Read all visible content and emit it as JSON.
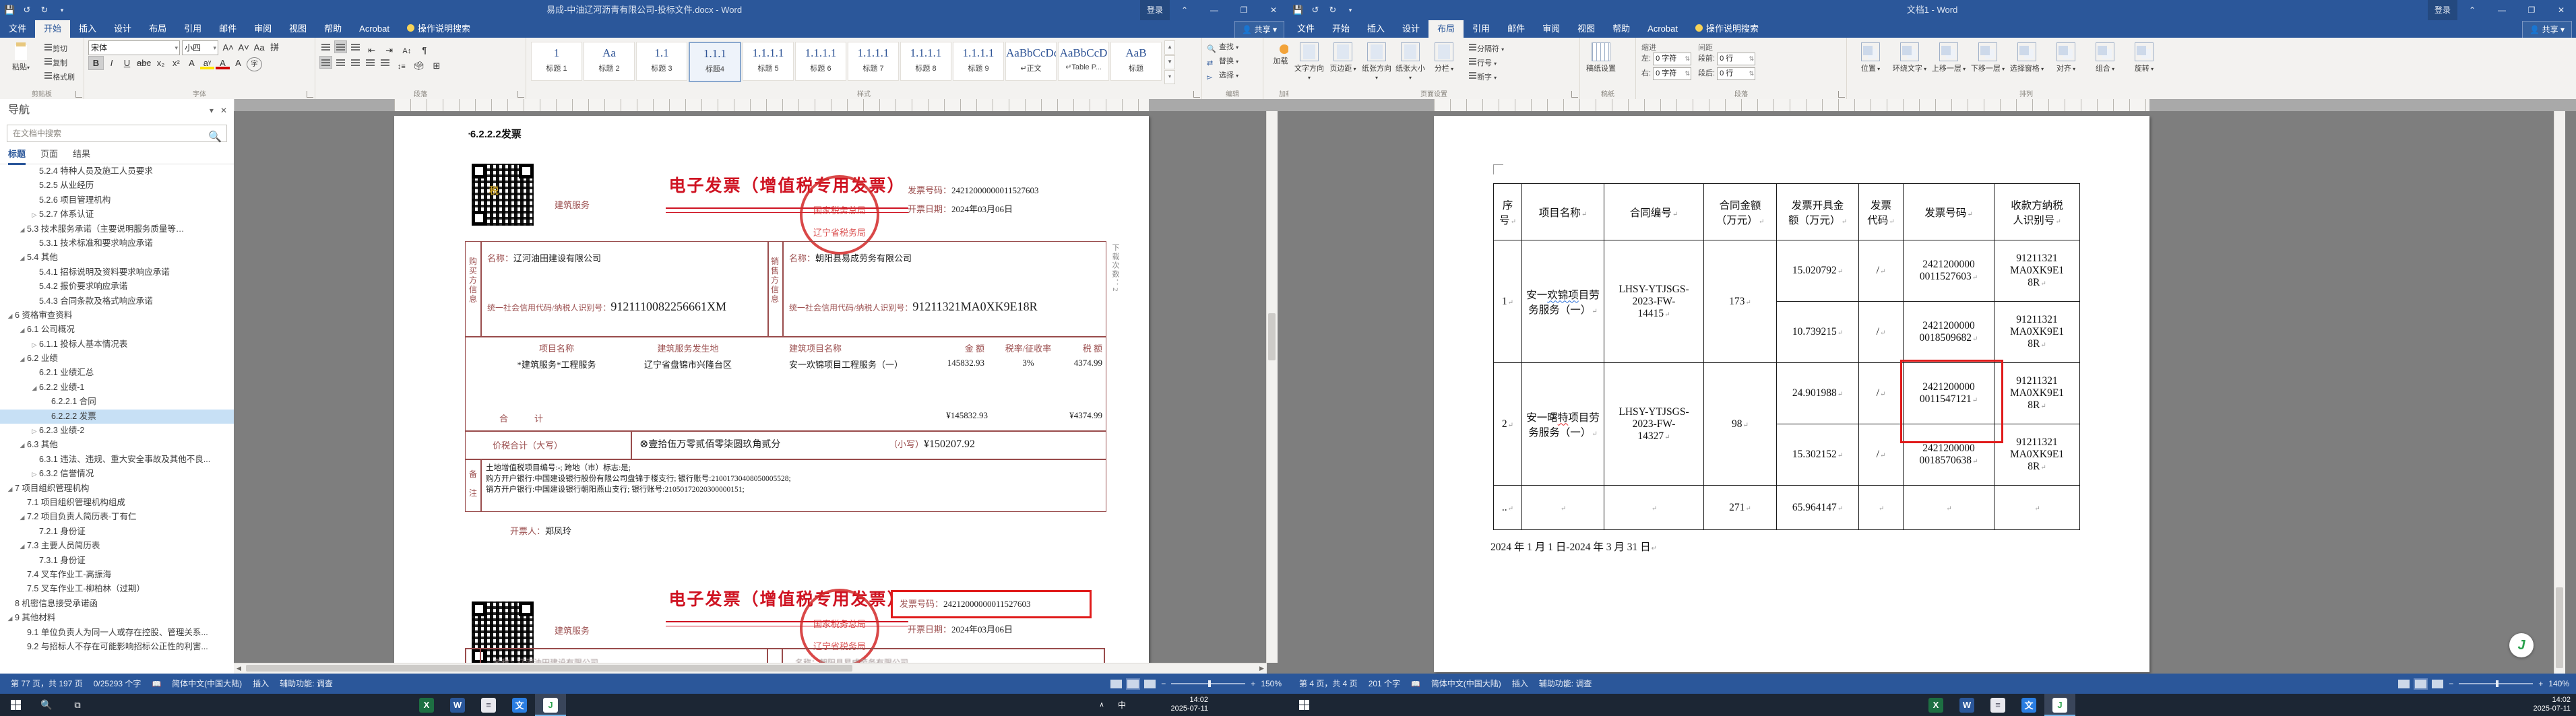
{
  "chrome": {
    "tabs": [
      "文件",
      "开始",
      "插入",
      "设计",
      "布局",
      "引用",
      "邮件",
      "审阅",
      "视图",
      "帮助",
      "Acrobat"
    ],
    "search_tab": "操作说明搜索",
    "share": "共享",
    "signin": "登录",
    "window_buttons": {
      "ribbon_options": "⌃",
      "minimize": "—",
      "restore": "❐",
      "close": "✕"
    },
    "qat_icons": [
      "save-icon",
      "undo-icon",
      "repeat-icon",
      "customize-arrow"
    ]
  },
  "left_window": {
    "title": "易成-中油辽河沥青有限公司-投标文件.docx - Word",
    "active_tab": "开始",
    "ribbon": {
      "clipboard": {
        "label": "剪贴板",
        "paste": "粘贴",
        "items": [
          "剪切",
          "复制",
          "格式刷"
        ]
      },
      "font": {
        "label": "字体",
        "font_name": "宋体",
        "font_size": "小四",
        "row_buttons": [
          "B",
          "I",
          "U",
          "abc",
          "x₂",
          "x²"
        ],
        "row_buttons2": [
          "A",
          "aᵞ",
          "A",
          "A",
          "字"
        ],
        "grow_shrink": [
          "A˄",
          "A˅",
          "Aa",
          "拼"
        ]
      },
      "paragraph": {
        "label": "段落"
      },
      "styles": {
        "label": "样式",
        "items": [
          {
            "preview": "1",
            "name": "标题 1"
          },
          {
            "preview": "Aa",
            "name": "标题 2"
          },
          {
            "preview": "1.1",
            "name": "标题 3"
          },
          {
            "preview": "1.1.1",
            "name": "标题4",
            "selected": true
          },
          {
            "preview": "1.1.1.1",
            "name": "标题 5"
          },
          {
            "preview": "1.1.1.1",
            "name": "标题 6"
          },
          {
            "preview": "1.1.1.1",
            "name": "标题 7"
          },
          {
            "preview": "1.1.1.1",
            "name": "标题 8"
          },
          {
            "preview": "1.1.1.1",
            "name": "标题 9"
          },
          {
            "preview": "AaBbCcDdE",
            "name": "↵正文"
          },
          {
            "preview": "AaBbCcD",
            "name": "↵Table P..."
          },
          {
            "preview": "AaB",
            "name": "标题"
          }
        ]
      },
      "editing": {
        "label": "编辑",
        "items": [
          "查找",
          "替换",
          "选择"
        ]
      },
      "addins": {
        "label": "加载项",
        "button": "加载项"
      }
    },
    "nav": {
      "title": "导航",
      "close": "✕",
      "chevron": "▾",
      "search_placeholder": "在文档中搜索",
      "tabs": [
        "标题",
        "页面",
        "结果"
      ],
      "active_nav_tab": "标题",
      "items": [
        {
          "t": "5.2.4 特种人员及施工人员要求",
          "l": 2,
          "a": ""
        },
        {
          "t": "5.2.5 从业经历",
          "l": 2,
          "a": ""
        },
        {
          "t": "5.2.6 项目管理机构",
          "l": 2,
          "a": ""
        },
        {
          "t": "5.2.7 体系认证",
          "l": 2,
          "a": "c"
        },
        {
          "t": "5.3 技术服务承诺（主要说明服务质量等…",
          "l": 1,
          "a": "e"
        },
        {
          "t": "5.3.1 技术标准和要求响应承诺",
          "l": 2,
          "a": ""
        },
        {
          "t": "5.4 其他",
          "l": 1,
          "a": "e"
        },
        {
          "t": "5.4.1 招标说明及资料要求响应承诺",
          "l": 2,
          "a": ""
        },
        {
          "t": "5.4.2 报价要求响应承诺",
          "l": 2,
          "a": ""
        },
        {
          "t": "5.4.3 合同条款及格式响应承诺",
          "l": 2,
          "a": ""
        },
        {
          "t": "6 资格审查资料",
          "l": 0,
          "a": "e"
        },
        {
          "t": "6.1 公司概况",
          "l": 1,
          "a": "e"
        },
        {
          "t": "6.1.1 投标人基本情况表",
          "l": 2,
          "a": "c"
        },
        {
          "t": "6.2 业绩",
          "l": 1,
          "a": "e"
        },
        {
          "t": "6.2.1 业绩汇总",
          "l": 2,
          "a": ""
        },
        {
          "t": "6.2.2 业绩-1",
          "l": 2,
          "a": "e"
        },
        {
          "t": "6.2.2.1 合同",
          "l": 3,
          "a": ""
        },
        {
          "t": "6.2.2.2 发票",
          "l": 3,
          "a": "",
          "sel": true
        },
        {
          "t": "6.2.3 业绩-2",
          "l": 2,
          "a": "c"
        },
        {
          "t": "6.3 其他",
          "l": 1,
          "a": "e"
        },
        {
          "t": "6.3.1 违法、违规、重大安全事故及其他不良...",
          "l": 2,
          "a": ""
        },
        {
          "t": "6.3.2 信誉情况",
          "l": 2,
          "a": "c"
        },
        {
          "t": "7 项目组织管理机构",
          "l": 0,
          "a": "e"
        },
        {
          "t": "7.1 项目组织管理机构组成",
          "l": 1,
          "a": ""
        },
        {
          "t": "7.2 项目负责人简历表-丁有仁",
          "l": 1,
          "a": "e"
        },
        {
          "t": "7.2.1 身份证",
          "l": 2,
          "a": ""
        },
        {
          "t": "7.3 主要人员简历表",
          "l": 1,
          "a": "e"
        },
        {
          "t": "7.3.1 身份证",
          "l": 2,
          "a": ""
        },
        {
          "t": "7.4 叉车作业工-高振海",
          "l": 1,
          "a": ""
        },
        {
          "t": "7.5 叉车作业工-柳柏林（过期）",
          "l": 1,
          "a": ""
        },
        {
          "t": "8 机密信息接受承诺函",
          "l": 0,
          "a": ""
        },
        {
          "t": "9 其他材料",
          "l": 0,
          "a": "e"
        },
        {
          "t": "9.1 单位负责人为同一人或存在控股、管理关系...",
          "l": 1,
          "a": ""
        },
        {
          "t": "9.2 与招标人不存在可能影响招标公正性的利害...",
          "l": 1,
          "a": ""
        }
      ]
    },
    "doc": {
      "heading": "6.2.2.2发票",
      "invoice": {
        "service_tag": "建筑服务",
        "title": "电子发票（增值税专用发票）",
        "stamp_top": "国家税务总局",
        "stamp_bottom": "辽宁省税务局",
        "number_label": "发票号码：",
        "number": "24212000000011527603",
        "date_label": "开票日期：",
        "date": "2024年03月06日",
        "buyer_side_label": "购买方信息",
        "seller_side_label": "销售方信息",
        "name_label": "名称：",
        "buyer_name": "辽河油田建设有限公司",
        "taxid_label": "统一社会信用代码/纳税人识别号：",
        "buyer_taxid": "9121110082256661XM",
        "seller_name": "朝阳县易成劳务有限公司",
        "seller_taxid": "91211321MA0XK9E18R",
        "item_headers": [
          "项目名称",
          "建筑服务发生地",
          "建筑项目名称",
          "金  额",
          "税率/征收率",
          "税  额"
        ],
        "item_row": [
          "*建筑服务*工程服务",
          "辽宁省盘锦市兴隆台区",
          "安一欢锦项目工程服务（一）",
          "145832.93",
          "3%",
          "4374.99"
        ],
        "total_label": "合　　　计",
        "total_amount": "¥145832.93",
        "total_tax": "¥4374.99",
        "grand_label": "价税合计（大写）",
        "grand_symbol": "⊗",
        "grand_cn": "壹拾伍万零贰佰零柒圆玖角贰分",
        "grand_small_label": "（小写）",
        "grand_small": "¥150207.92",
        "remark_label": "备注",
        "remark_lines": [
          "土地增值税项目编号:-;      跨地（市）标志:是;",
          "购方开户银行:中国建设银行股份有限公司盘锦于楼支行;      银行账号:21001730408050005528;",
          "销方开户银行:中国建设银行朝阳燕山支行;      银行账号:21050172020300000151;"
        ],
        "issuer_label": "开票人：",
        "issuer": "郑凤玲",
        "download_note": "下载次数：2"
      }
    },
    "status": {
      "items": [
        "第 77 页，共 197 页",
        "0/25293 个字",
        "简体中文(中国大陆)",
        "插入",
        "辅助功能: 调查"
      ],
      "zoom": "150%"
    }
  },
  "right_window": {
    "title": "文档1 - Word",
    "active_tab": "布局",
    "ribbon": {
      "page_setup": {
        "label": "页面设置",
        "big": [
          "文字方向",
          "页边距",
          "纸张方向",
          "纸张大小",
          "分栏"
        ],
        "small": [
          "分隔符",
          "行号",
          "断字"
        ]
      },
      "paper": {
        "label": "稿纸",
        "big": [
          "稿纸设置"
        ]
      },
      "paragraph": {
        "label": "段落",
        "groups": [
          {
            "name": "缩进",
            "rows": [
              [
                "左:",
                "0 字符"
              ],
              [
                "右:",
                "0 字符"
              ]
            ]
          },
          {
            "name": "间距",
            "rows": [
              [
                "段前:",
                "0 行"
              ],
              [
                "段后:",
                "0 行"
              ]
            ]
          }
        ]
      },
      "arrange": {
        "label": "排列",
        "big": [
          "位置",
          "环绕文字",
          "上移一层",
          "下移一层",
          "选择窗格",
          "对齐",
          "组合",
          "旋转"
        ]
      }
    },
    "doc": {
      "table": {
        "headers": [
          "序\n号",
          "项目名称",
          "合同编号",
          "合同金额\n（万元）",
          "发票开具金\n额（万元）",
          "发票\n代码",
          "发票号码",
          "收款方纳税\n人识别号"
        ],
        "rows": [
          {
            "no": "1",
            "project": [
              [
                "安一",
                ""
              ],
              [
                "欢锦项",
                "b"
              ],
              [
                "目劳务服务（一）",
                ""
              ]
            ],
            "contract": "LHSY-YTJSGS-\n2023-FW-\n14415",
            "amount": "173",
            "subs": [
              {
                "fee": "15.020792",
                "code": "/",
                "num": "2421200000\n0011527603",
                "tax": "91211321\nMA0XK9E1\n8R"
              },
              {
                "fee": "10.739215",
                "code": "/",
                "num": "2421200000\n0018509682",
                "tax": "91211321\nMA0XK9E1\n8R"
              }
            ]
          },
          {
            "no": "2",
            "project": [
              [
                "安一曙",
                ""
              ],
              [
                "特",
                "r"
              ],
              [
                "项目劳务服务（一）",
                ""
              ]
            ],
            "contract": "LHSY-YTJSGS-\n2023-FW-\n14327",
            "amount": "98",
            "subs": [
              {
                "fee": "24.901988",
                "code": "/",
                "num": "2421200000\n0011547121",
                "tax": "91211321\nMA0XK9E1\n8R",
                "redbox": true
              },
              {
                "fee": "15.302152",
                "code": "/",
                "num": "2421200000\n0018570638",
                "tax": "91211321\nMA0XK9E1\n8R"
              }
            ]
          }
        ],
        "total": {
          "no": "..",
          "amount": "271",
          "fee": "65.964147"
        },
        "note": "2024 年 1 月 1 日-2024 年 3 月 31 日"
      }
    },
    "status": {
      "items": [
        "第 4 页，共 4 页",
        "201 个字",
        "简体中文(中国大陆)",
        "插入",
        "辅助功能: 调查"
      ],
      "zoom": "140%"
    }
  },
  "taskbar": {
    "time": "14:02",
    "date": "2025-07-11",
    "apps": [
      {
        "name": "excel",
        "glyph": "X",
        "color": "#1d6f42"
      },
      {
        "name": "word",
        "glyph": "W",
        "color": "#2b579a"
      },
      {
        "name": "notepad",
        "glyph": "≡",
        "color": "#e8e8ee",
        "fg": "#556"
      },
      {
        "name": "translate",
        "glyph": "文",
        "color": "#2a7de1"
      },
      {
        "name": "green-app",
        "glyph": "J",
        "color": "#ffffff",
        "fg": "#2aa14d",
        "active": true
      }
    ]
  }
}
